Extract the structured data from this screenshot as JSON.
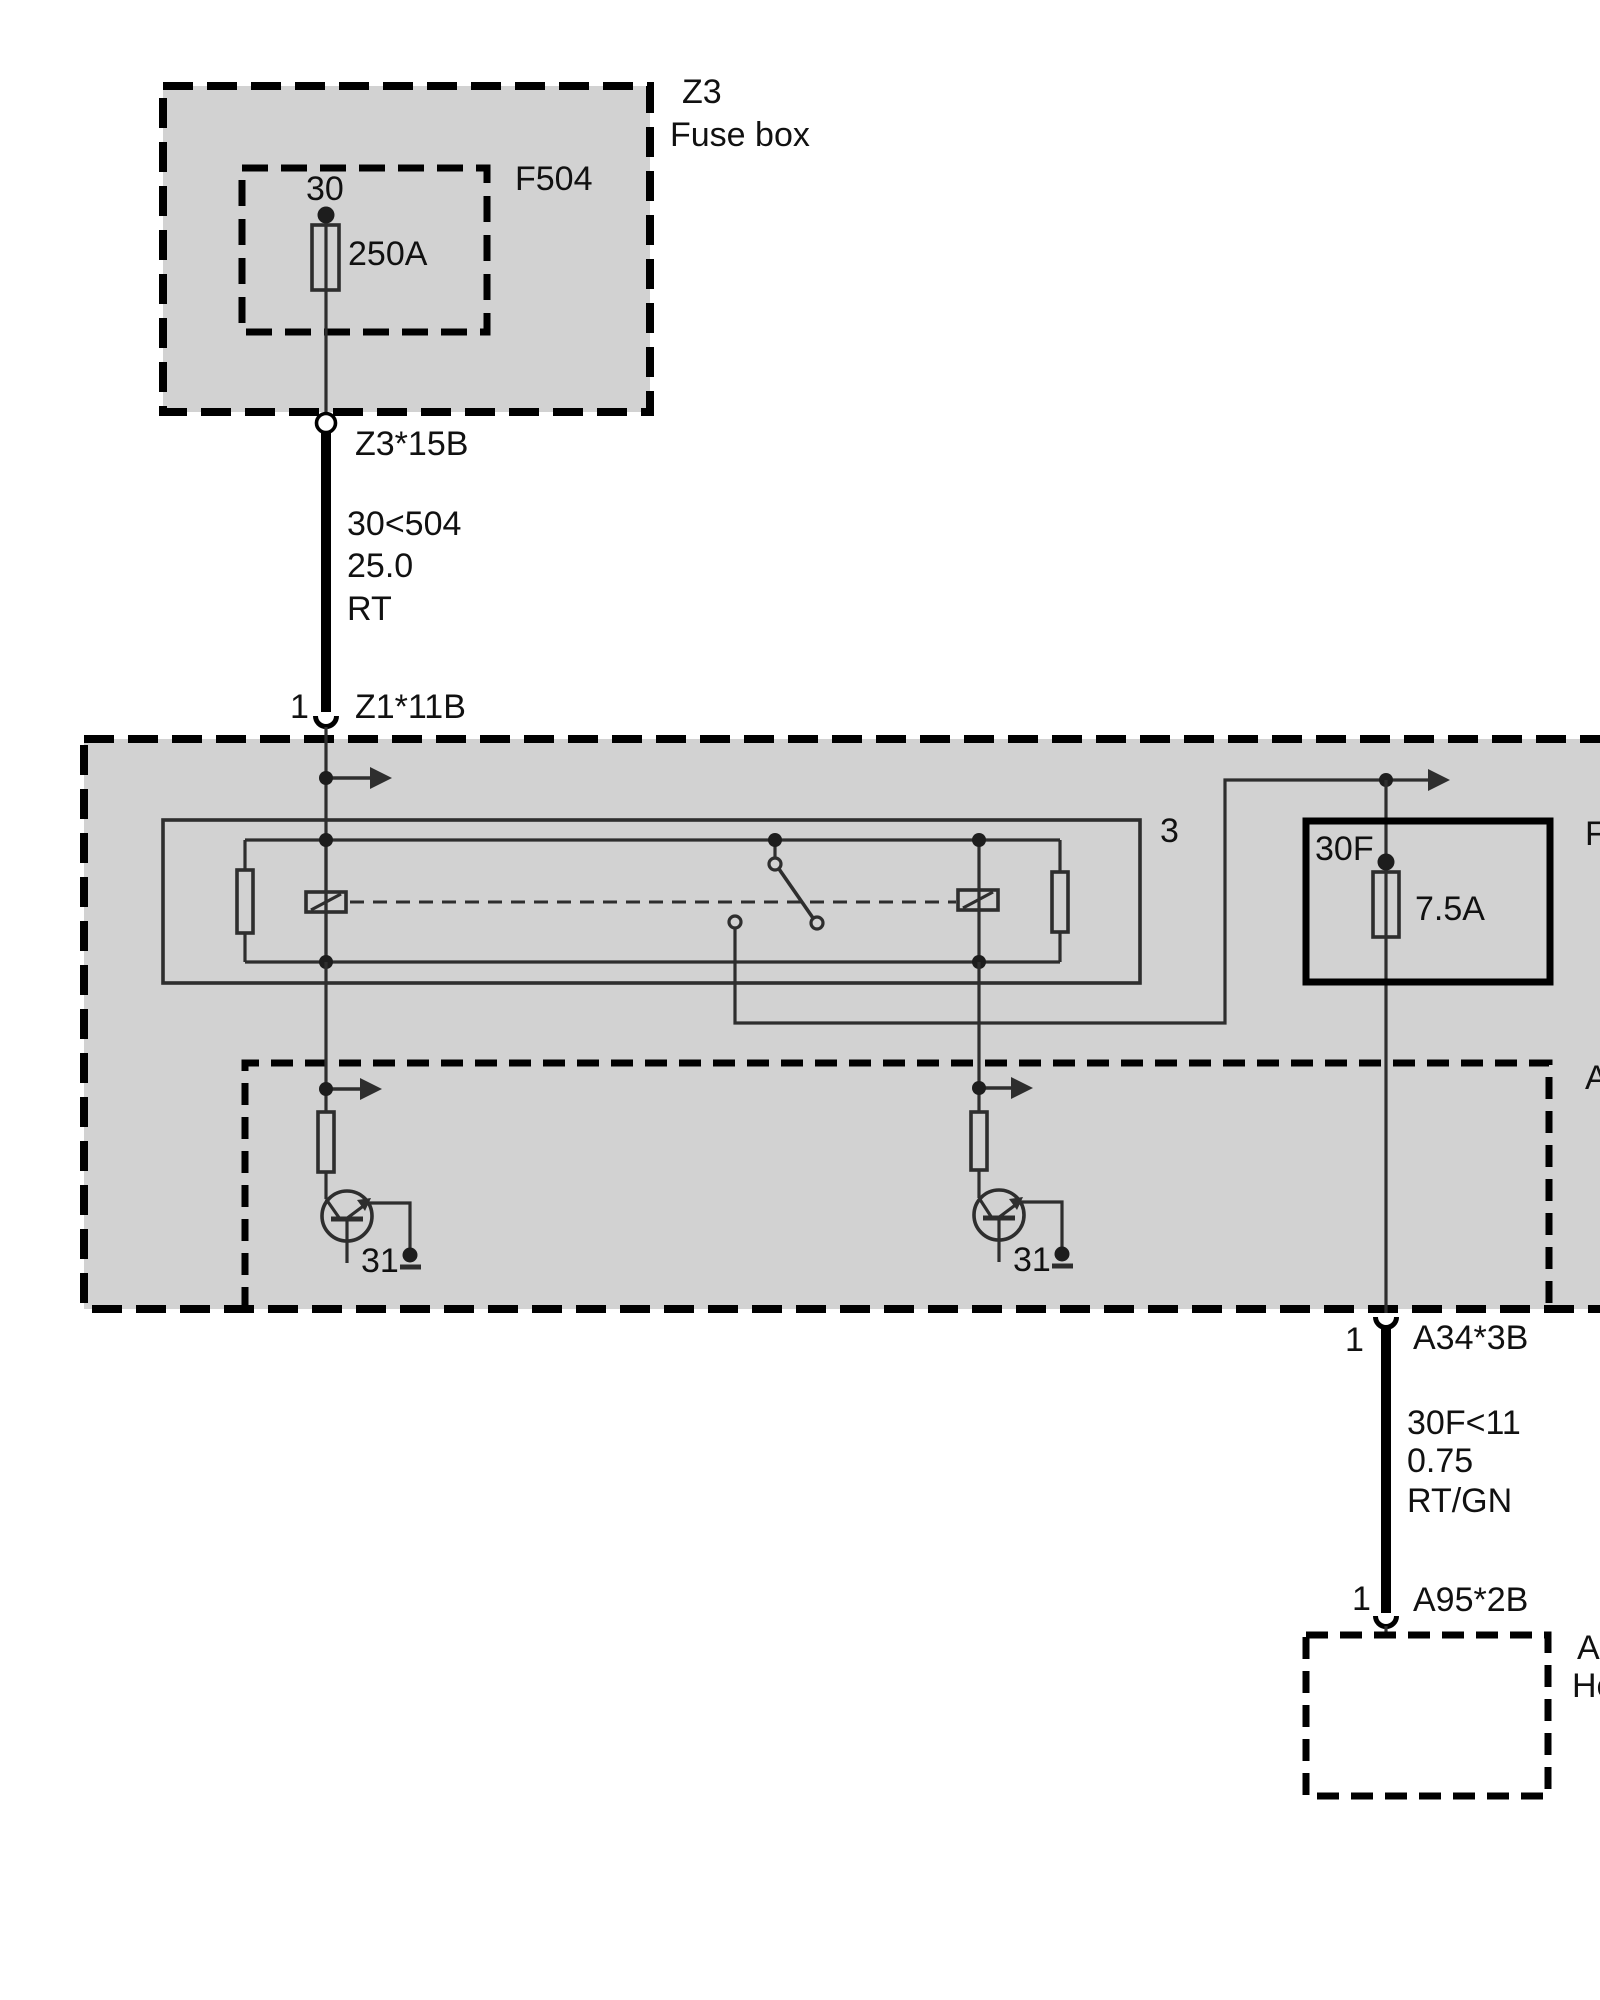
{
  "colors": {
    "panel_fill": "#d2d2d2",
    "line": "#2e2e2e",
    "outline": "#000000",
    "text": "#111111"
  },
  "z3_box": {
    "id": "Z3",
    "name": "Fuse box",
    "inner_fuse_id": "F504",
    "terminal": "30",
    "fuse_rating": "250A"
  },
  "connector_z3_15b": {
    "label": "Z3*15B"
  },
  "wire_feed": {
    "circuit": "30<504",
    "cross_section": "25.0",
    "color_code": "RT"
  },
  "connector_z1_11b": {
    "pin": "1",
    "label": "Z1*11B"
  },
  "relay_block": {
    "label": "3"
  },
  "fuse_30f": {
    "terminal": "30F",
    "rating": "7.5A"
  },
  "partial_labels": {
    "fuse_box_right": "F",
    "control_unit_right": "A",
    "bottom_box_line1": "A",
    "bottom_box_line2": "He"
  },
  "ground_left": {
    "label": "31"
  },
  "ground_right": {
    "label": "31"
  },
  "connector_a34_3b": {
    "pin": "1",
    "label": "A34*3B"
  },
  "wire_output": {
    "circuit": "30F<11",
    "cross_section": "0.75",
    "color_code": "RT/GN"
  },
  "connector_a95_2b": {
    "pin": "1",
    "label": "A95*2B"
  }
}
